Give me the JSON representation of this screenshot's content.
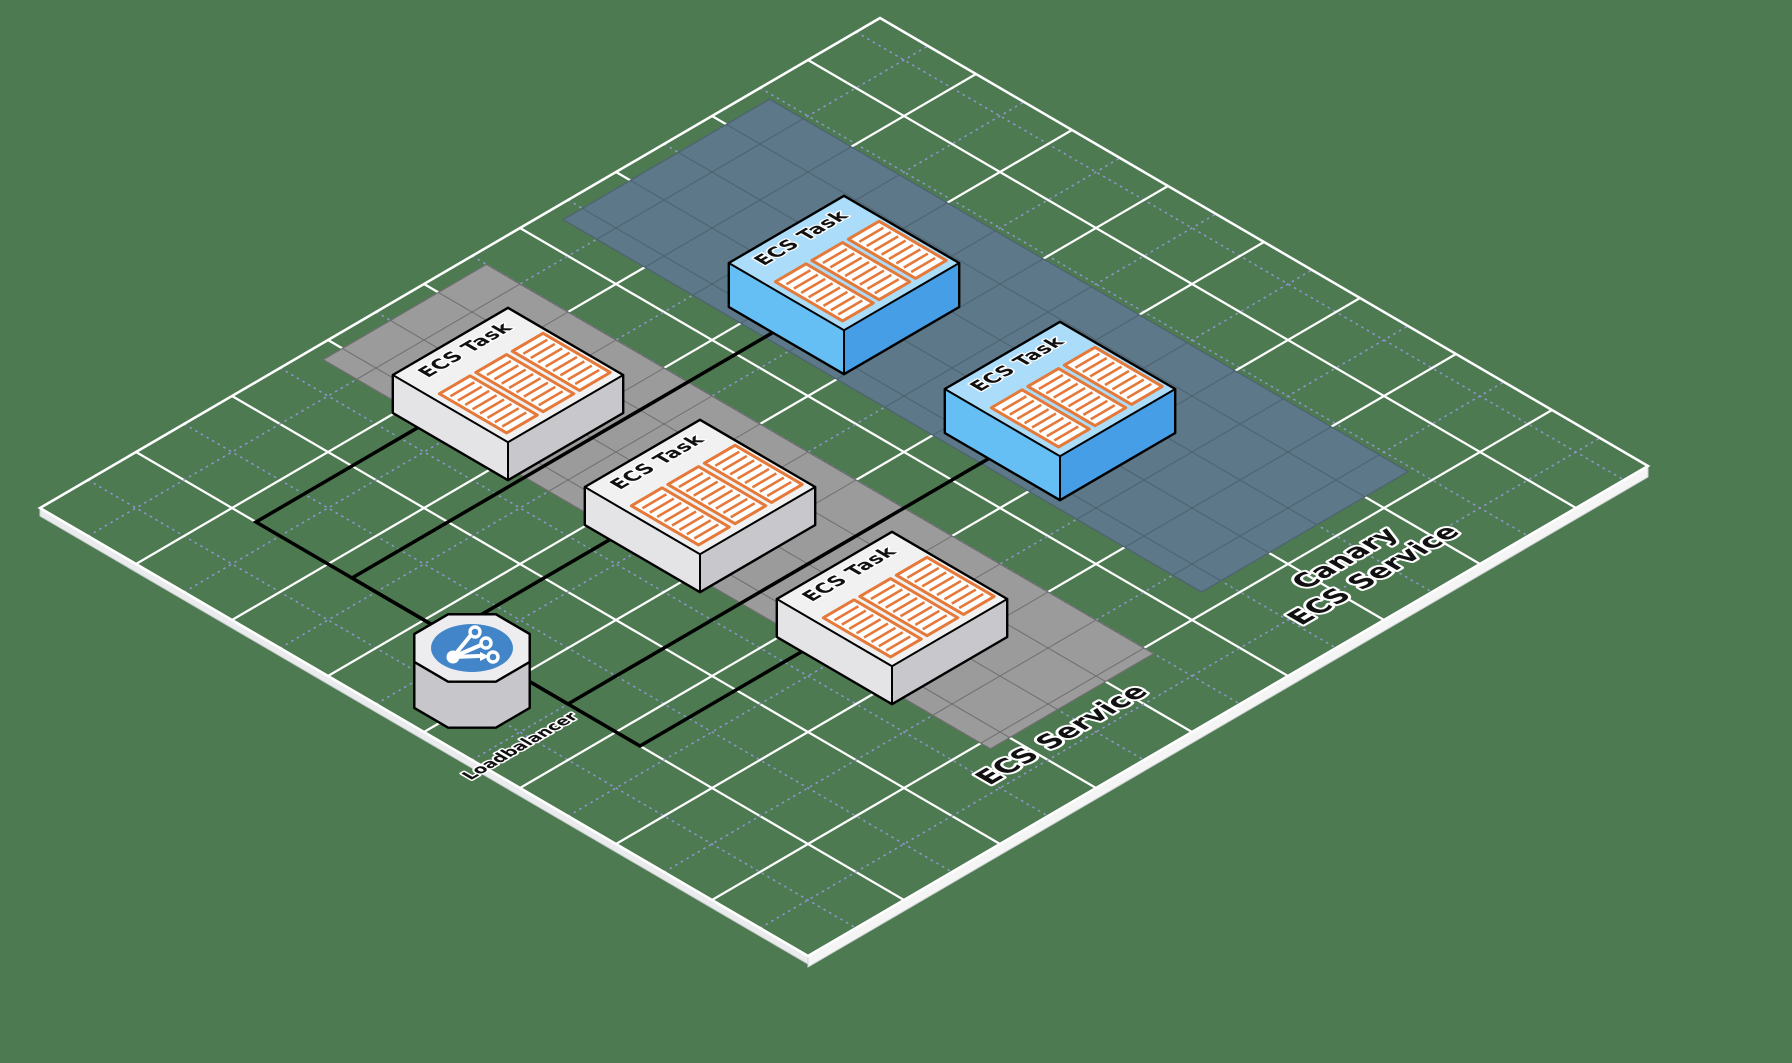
{
  "diagram": {
    "background_color": "#4e7a52",
    "plane": {
      "grid_major_color": "#ffffff",
      "grid_minor_color": "#9096d2",
      "edge_color": "#f5f5f5",
      "edge_side_color": "#e9ebec"
    },
    "loadbalancer": {
      "label": "Loadbalancer",
      "icon": "load-balancer-branch-icon",
      "circle_color": "#4285c8",
      "body_top_color": "#ededf0",
      "body_side_color": "#c7c7cb"
    },
    "services": [
      {
        "id": "ecs-service",
        "label": "ECS Service",
        "band_color": "#9b9b9b",
        "band_grid_color": "#6e6e6e",
        "task_label": "ECS Task",
        "task_count": 3,
        "task_colors": {
          "top": "#f1f1f2",
          "left": "#e4e4e7",
          "right": "#c8c8cc"
        }
      },
      {
        "id": "canary-ecs-service",
        "label_lines": [
          "Canary",
          "ECS Service"
        ],
        "band_color": "#5d7888",
        "band_grid_color": "#4d6271",
        "task_label": "ECS Task",
        "task_count": 2,
        "task_colors": {
          "top": "#abdcf9",
          "left": "#65bef4",
          "right": "#469fe6"
        }
      }
    ],
    "container_color": "#e5793a",
    "arrow_color": "#000000",
    "text_color": "#111111",
    "connections": [
      {
        "from": "loadbalancer",
        "to": "ecs-service-task-1"
      },
      {
        "from": "loadbalancer",
        "to": "ecs-service-task-2"
      },
      {
        "from": "loadbalancer",
        "to": "ecs-service-task-3"
      },
      {
        "from": "loadbalancer",
        "to": "canary-ecs-service-task-1"
      },
      {
        "from": "loadbalancer",
        "to": "canary-ecs-service-task-2"
      }
    ]
  }
}
